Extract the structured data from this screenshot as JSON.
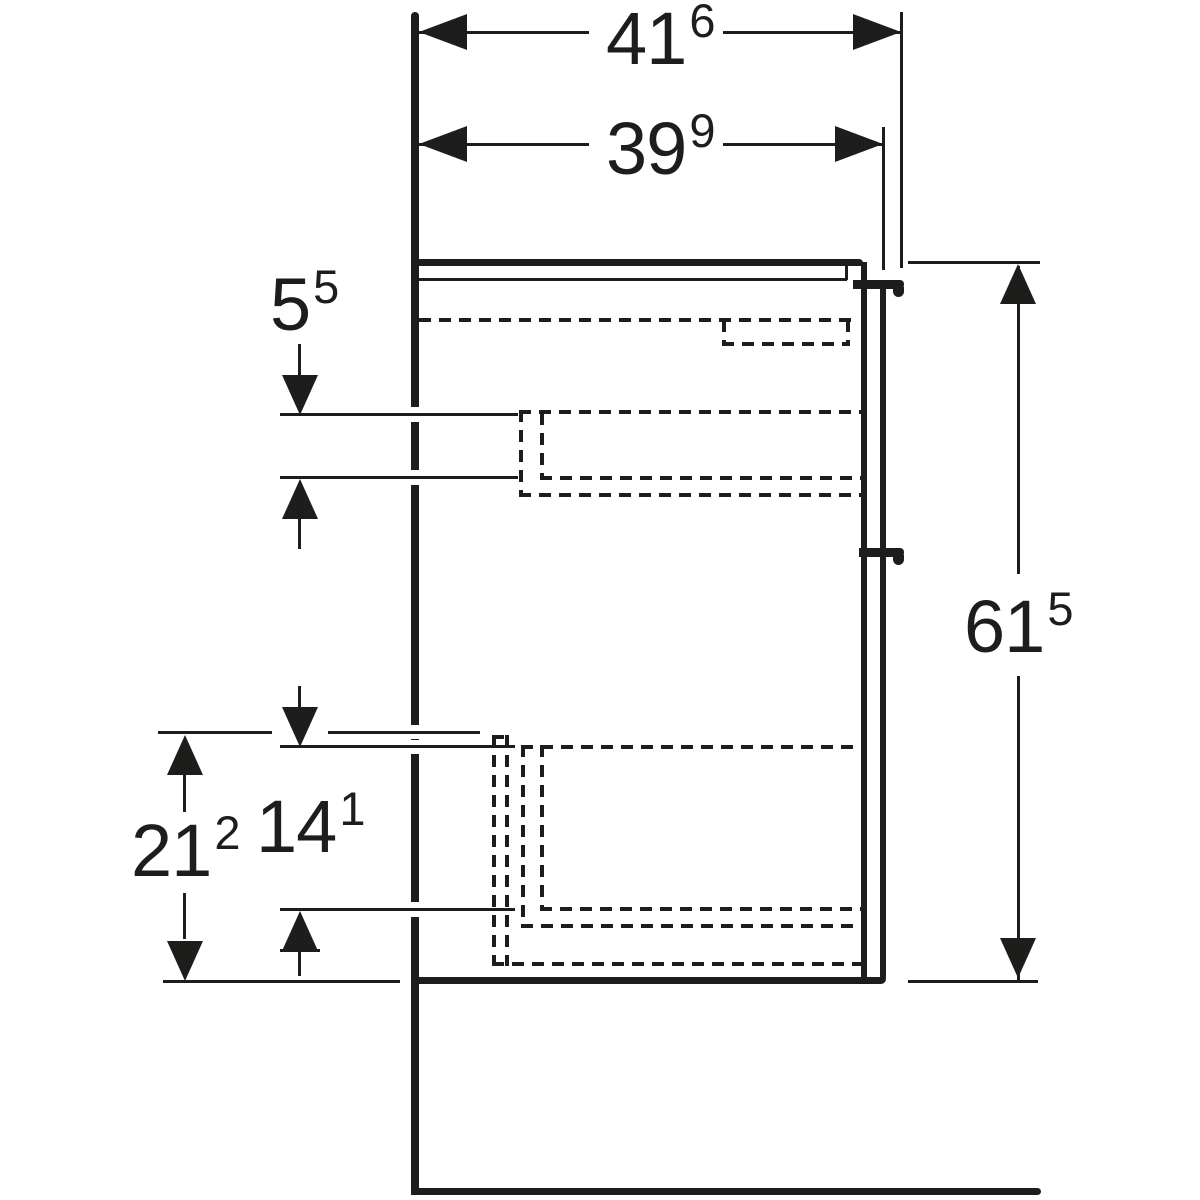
{
  "drawing": {
    "kind": "technical side-view drawing of wall-hung two-drawer vanity cabinet",
    "ink_color": "#1d1d1b",
    "background_color": "#ffffff"
  },
  "dims": {
    "depth_with_handle": {
      "value": "41",
      "sup": "6"
    },
    "depth_without_handle": {
      "value": "39",
      "sup": "9"
    },
    "total_height": {
      "value": "61",
      "sup": "5"
    },
    "top_inset": {
      "value": "5",
      "sup": "5"
    },
    "lower_front_height": {
      "value": "21",
      "sup": "2"
    },
    "lower_inner_height": {
      "value": "14",
      "sup": "1"
    }
  }
}
